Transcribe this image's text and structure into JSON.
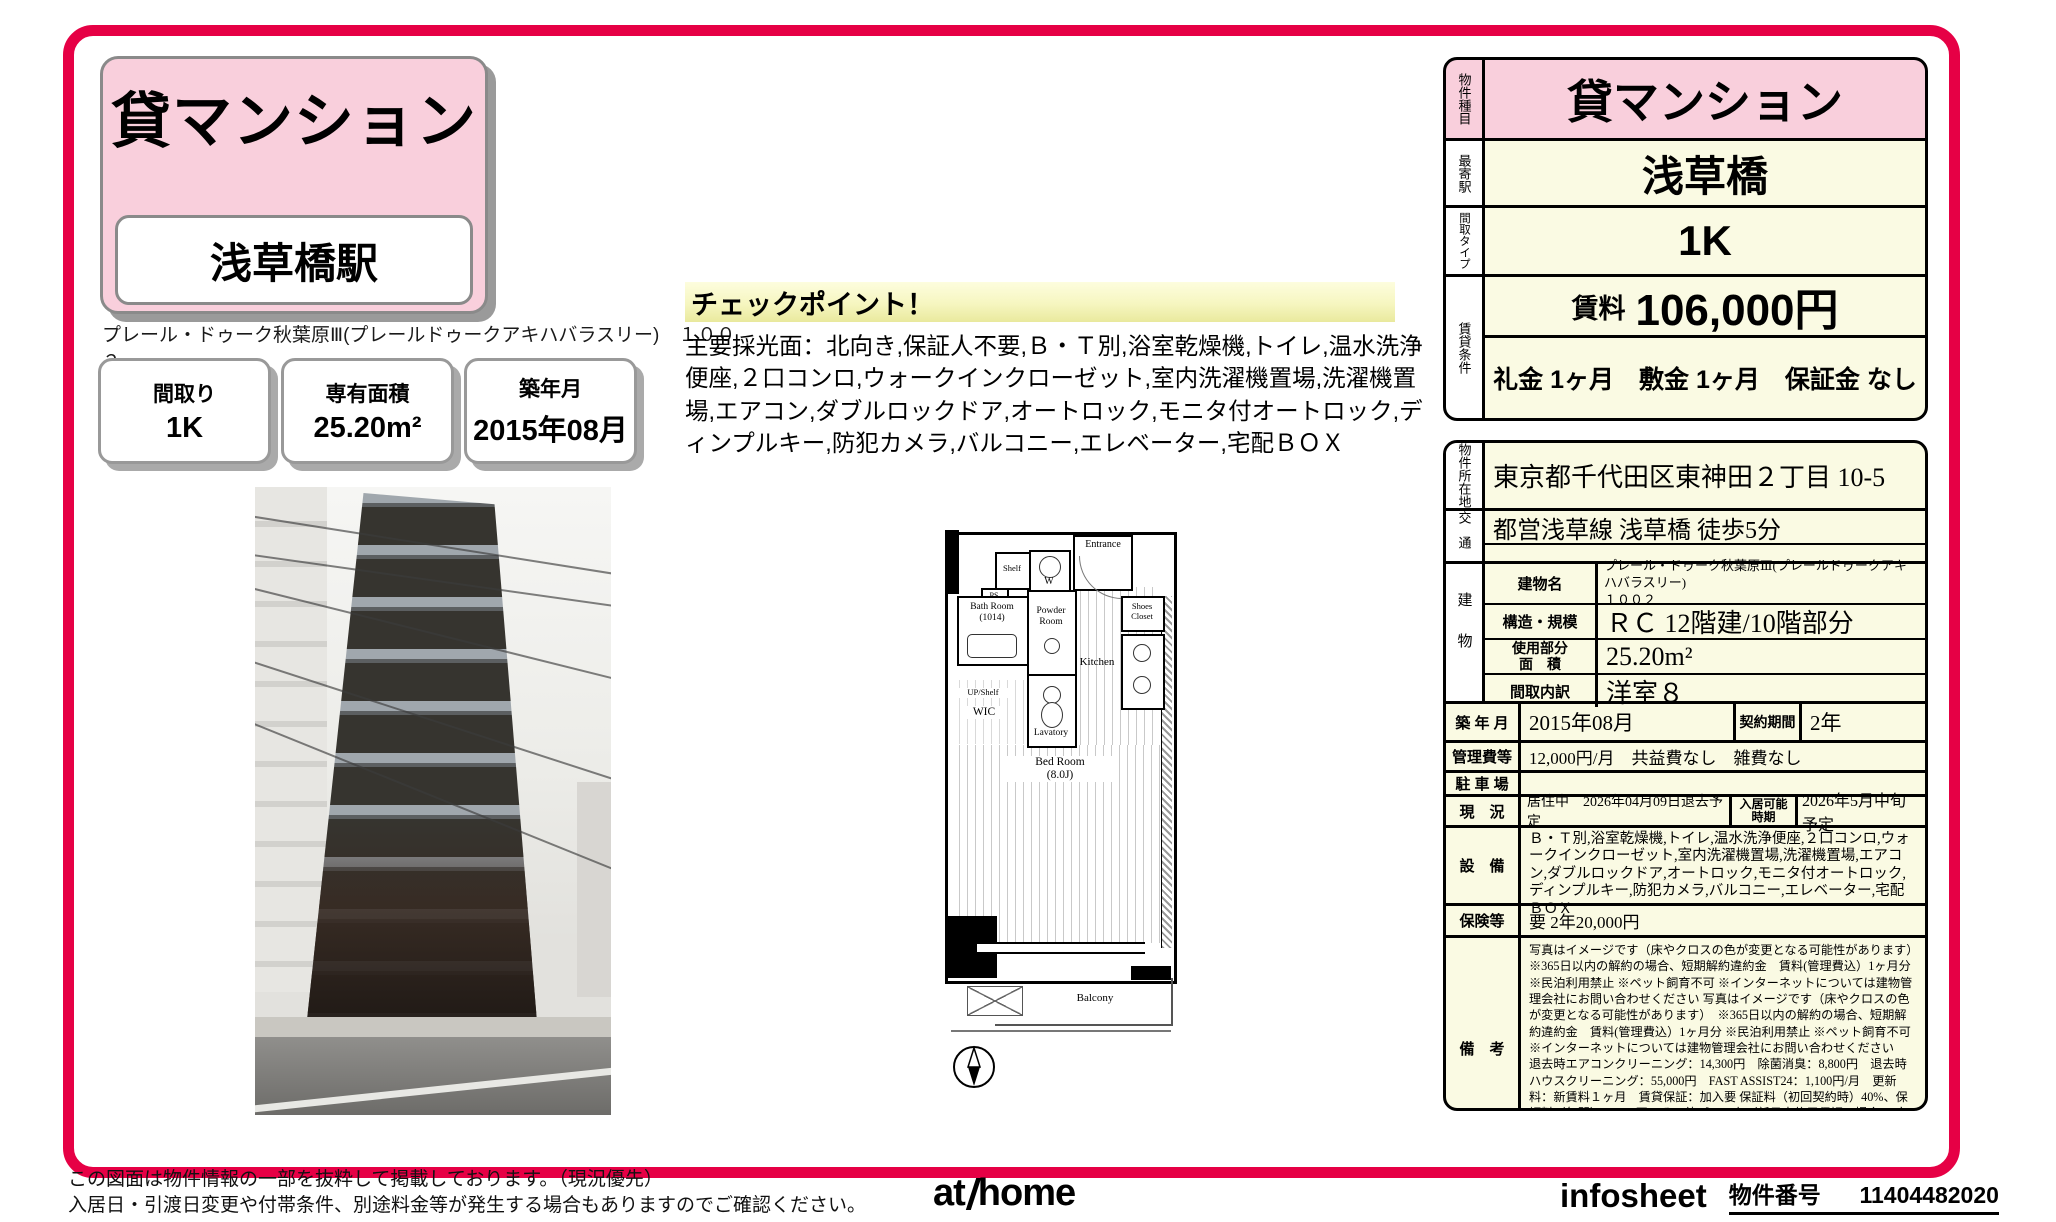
{
  "colors": {
    "accent": "#e60045",
    "pink": "#f9cfdc",
    "cream": "#fafae3",
    "checkpoint_yellow": "#f6f6c0"
  },
  "header": {
    "type_badge": "貸マンション",
    "station_badge": "浅草橋駅",
    "building_name_line": "プレール・ドゥーク秋葉原Ⅲ(プレールドゥークアキハバラスリー)　１００２",
    "boxes": [
      {
        "label": "間取り",
        "value": "1K"
      },
      {
        "label": "専有面積",
        "value": "25.20m²"
      },
      {
        "label": "築年月",
        "value": "2015年08月"
      }
    ]
  },
  "checkpoint": {
    "heading": "チェックポイント！",
    "body": "主要採光面：北向き,保証人不要,Ｂ・Ｔ別,浴室乾燥機,トイレ,温水洗浄便座,２口コンロ,ウォークインクローゼット,室内洗濯機置場,洗濯機置場,エアコン,ダブルロックドア,オートロック,モニタ付オートロック,ディンプルキー,防犯カメラ,バルコニー,エレベーター,宅配ＢＯＸ"
  },
  "floorplan": {
    "labels": {
      "shelf": "Shelf",
      "washer": "W",
      "entrance": "Entrance",
      "ps": "PS",
      "bath": "Bath Room\n(1014)",
      "powder": "Powder\nRoom",
      "shoes": "Shoes\nCloset",
      "kitchen": "Kitchen",
      "upshelf": "UP/Shelf",
      "wic": "WIC",
      "lavatory": "Lavatory",
      "bedroom": "Bed Room\n(8.0J)",
      "balcony": "Balcony"
    }
  },
  "summary": {
    "rows": [
      {
        "label": "物件種目",
        "value": "貸マンション"
      },
      {
        "label": "最寄駅",
        "value": "浅草橋"
      },
      {
        "label": "間取タイプ",
        "value": "1K"
      }
    ],
    "rent_section_label": "賃貸条件",
    "rent_label": "賃料",
    "rent_value": "106,000円",
    "terms": "礼金 1ヶ月　敷金 1ヶ月　保証金 なし"
  },
  "details": {
    "address_label": "物件所在地",
    "address": "東京都千代田区東神田２丁目 10-5",
    "access_label": "交通",
    "access": "都営浅草線 浅草橋 徒歩5分",
    "building_label": "建物",
    "building_name_label": "建物名",
    "building_name": "プレール・ドゥーク秋葉原Ⅲ(プレールドゥークアキハバラスリー)\n１００２",
    "structure_label": "構造・規模",
    "structure": "ＲＣ 12階建/10階部分",
    "area_label": "使用部分\n面　積",
    "area": "25.20m²",
    "layout_label": "間取内訳",
    "layout": "洋室８",
    "built_label": "築 年 月",
    "built": "2015年08月",
    "contract_label": "契約期間",
    "contract": "2年",
    "fees_label": "管理費等",
    "fees": "12,000円/月　共益費なし　雑費なし",
    "parking_label": "駐 車 場",
    "parking": "",
    "status_label": "現　況",
    "status": "居住中　2026年04月09日退去予定",
    "movein_label": "入居可能\n時期",
    "movein": "2026年5月中旬予定",
    "equipment_label": "設　備",
    "equipment": "Ｂ・Ｔ別,浴室乾燥機,トイレ,温水洗浄便座,２口コンロ,ウォークインクローゼット,室内洗濯機置場,洗濯機置場,エアコン,ダブルロックドア,オートロック,モニタ付オートロック,ディンプルキー,防犯カメラ,バルコニー,エレベーター,宅配ＢＯＸ",
    "insurance_label": "保険等",
    "insurance": "要 2年20,000円",
    "notes_label": "備　考",
    "notes": "写真はイメージです（床やクロスの色が変更となる可能性があります）　※365日以内の解約の場合、短期解約違約金　賃料(管理費込）1ヶ月分 ※民泊利用禁止 ※ペット飼育不可 ※インターネットについては建物管理会社にお問い合わせください 写真はイメージです（床やクロスの色が変更となる可能性があります）　※365日以内の解約の場合、短期解約違約金　賃料(管理費込）1ヶ月分 ※民泊利用禁止 ※ペット飼育不可 ※インターネットについては建物管理会社にお問い合わせください　退去時エアコンクリーニング：14,300円　除菌消臭：8,800円　退去時ハウスクリーニング：55,000円　FAST ASSIST24：1,100円/月　更新料：新賃料１ヶ月　賃貸保証：加入要 保証料（初回契約時）40%、保証料（年間）10,000円、その他プラン有（新日本信用保証の場合 口座振替手数料216円（税込）/月）　利用駅１：ＪＲ総武本線 馬喰町 徒歩6分　利用駅２：都営新宿線 岩本町 徒歩7分"
  },
  "footer": {
    "disclaimer_line1": "この図面は物件情報の一部を抜粋して掲載しております。（現況優先）",
    "disclaimer_line2": "入居日・引渡日変更や付帯条件、別途料金等が発生する場合もありますのでご確認ください。",
    "logo_left": "at",
    "logo_right": "home",
    "infosheet_label": "infosheet",
    "property_no_label": "物件番号",
    "property_no": "11404482020"
  }
}
